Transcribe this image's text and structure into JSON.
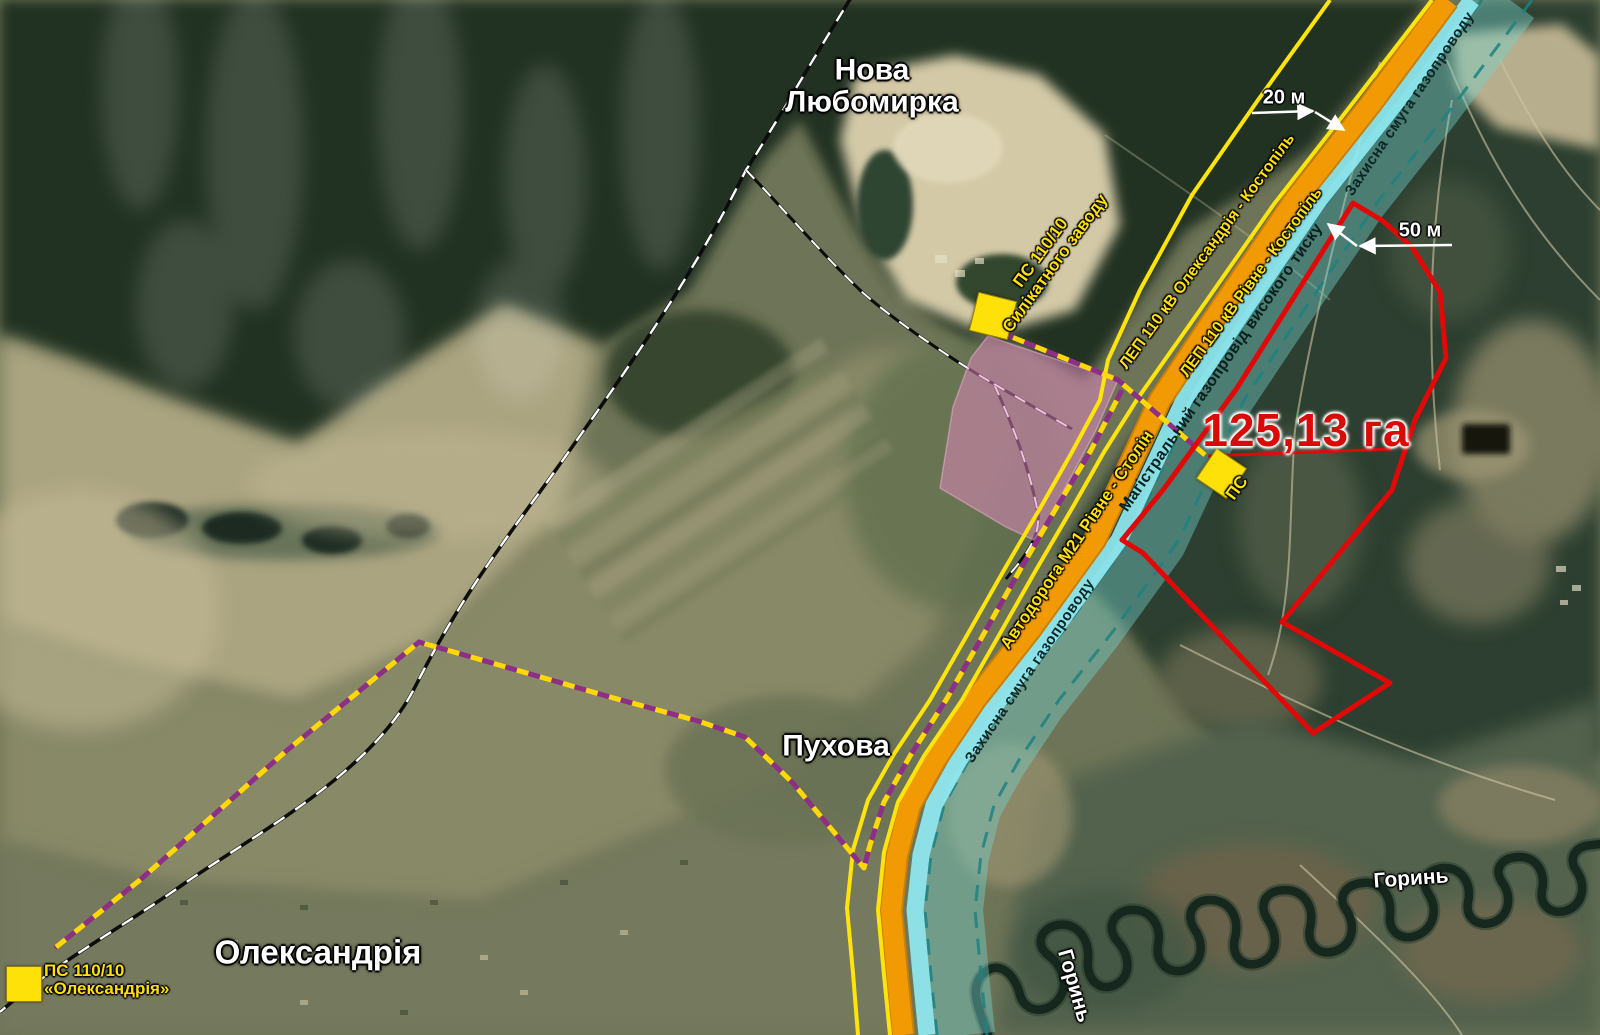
{
  "site": {
    "area_label": "125,13 га",
    "area_value_ha": "125,13"
  },
  "places": {
    "nova_liubomyrka_line1": "Нова",
    "nova_liubomyrka_line2": "Любомирка",
    "pukhova": "Пухова",
    "oleksandriia": "Олександрія"
  },
  "rivers": {
    "horyn_a": "Горинь",
    "horyn_b": "Горинь"
  },
  "infrastructure": {
    "lep1": "ЛЕП 110 кВ Олександрія - Костопіль",
    "lep2": "ЛЕП 110 кВ Рівне - Костопіль",
    "road": "Автодорога М21 Рівне - Столін",
    "pipeline": "Магістральний газопровід високого тиску",
    "zone_top": "Захисна смуга газопроводу",
    "zone_bottom": "Захисна смуга газопроводу"
  },
  "substations": {
    "plant_line1": "ПС 110/10",
    "plant_line2": "Силікатного заводу",
    "oleks_line1": "ПС 110/10",
    "oleks_line2": "«Олександрія»",
    "onsite": "ПС"
  },
  "dimensions": {
    "lep_gap": "20 м",
    "pipeline_offset": "50 м"
  },
  "palette": {
    "road_orange": "#f29a04",
    "lep_yellow": "#ffe40a",
    "pipeline_strip_cyan": "#8fe9f2",
    "protection_band_teal": "#74d4d0",
    "band_edge_dash": "#1d8182",
    "plot_red": "#e10808",
    "cable_purple": "#8e2f86",
    "industrial_pink": "#e289c0",
    "marker_yellow": "#ffe10a"
  }
}
